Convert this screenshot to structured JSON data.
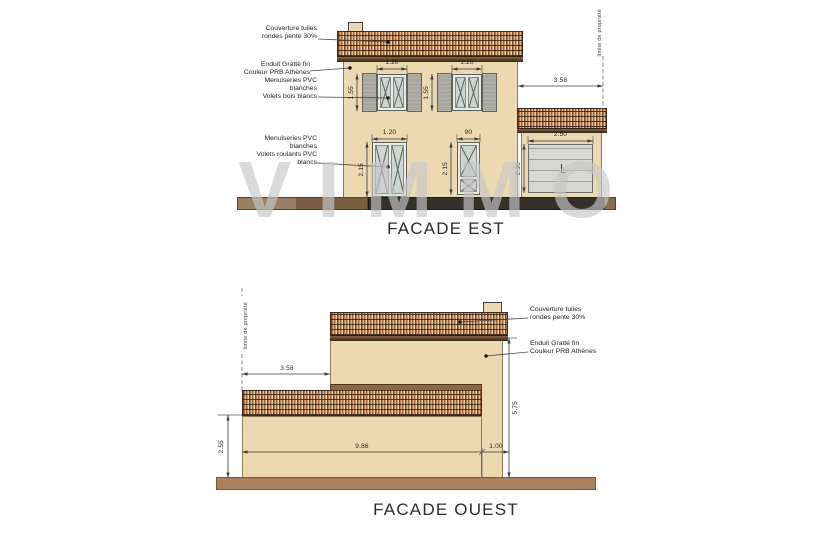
{
  "watermark": "VIMMO",
  "est": {
    "title": "FACADE EST",
    "property_line": "limite de propriété",
    "ann_roof": "Couverture tuiles\nrondes pente 30%",
    "ann_render": "Enduit Gratté fin\nCouleur PRB Athènes",
    "ann_windows": "Menuiseries PVC\nblanches\nVolets bois blancs",
    "ann_doors": "Menuiseries PVC\nblanches\nVolets roulants PVC\nblancs",
    "dim_offset": "3.58",
    "dim_window_w": "1.20",
    "dim_window_h": "1.55",
    "dim_door1_w": "1.20",
    "dim_door1_h": "2.15",
    "dim_door2_w": "90",
    "dim_door2_h": "2.15",
    "dim_garage_w": "2.50",
    "dim_garage_h": "2.10"
  },
  "ouest": {
    "title": "FACADE OUEST",
    "property_line": "limite de propriété",
    "ann_roof": "Couverture tuiles\nrondes pente 30%",
    "ann_render": "Enduit Gratté fin\nCouleur PRB Athènes",
    "dim_offset": "3.58",
    "dim_low_h": "2.55",
    "dim_main_w": "9.86",
    "dim_right_w": "1.00",
    "dim_total_h": "5.75"
  }
}
